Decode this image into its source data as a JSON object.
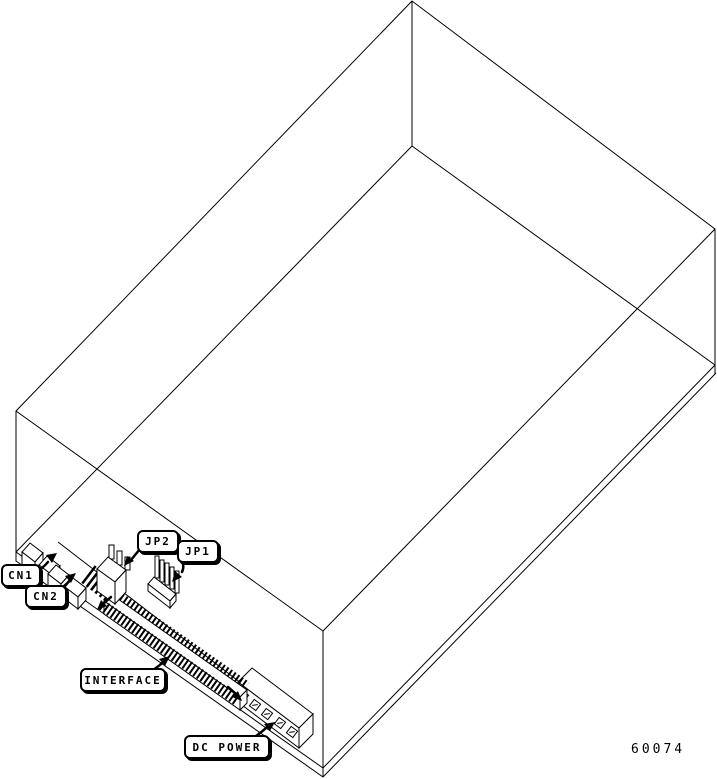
{
  "figure": {
    "number": "60074"
  },
  "colors": {
    "line": "#000000",
    "background": "#ffffff"
  },
  "callouts": [
    {
      "id": "cn1",
      "label": "CN1"
    },
    {
      "id": "cn2",
      "label": "CN2"
    },
    {
      "id": "jp2",
      "label": "JP2"
    },
    {
      "id": "jp1",
      "label": "JP1"
    },
    {
      "id": "interface",
      "label": "INTERFACE"
    },
    {
      "id": "dc-power",
      "label": "DC POWER"
    }
  ]
}
